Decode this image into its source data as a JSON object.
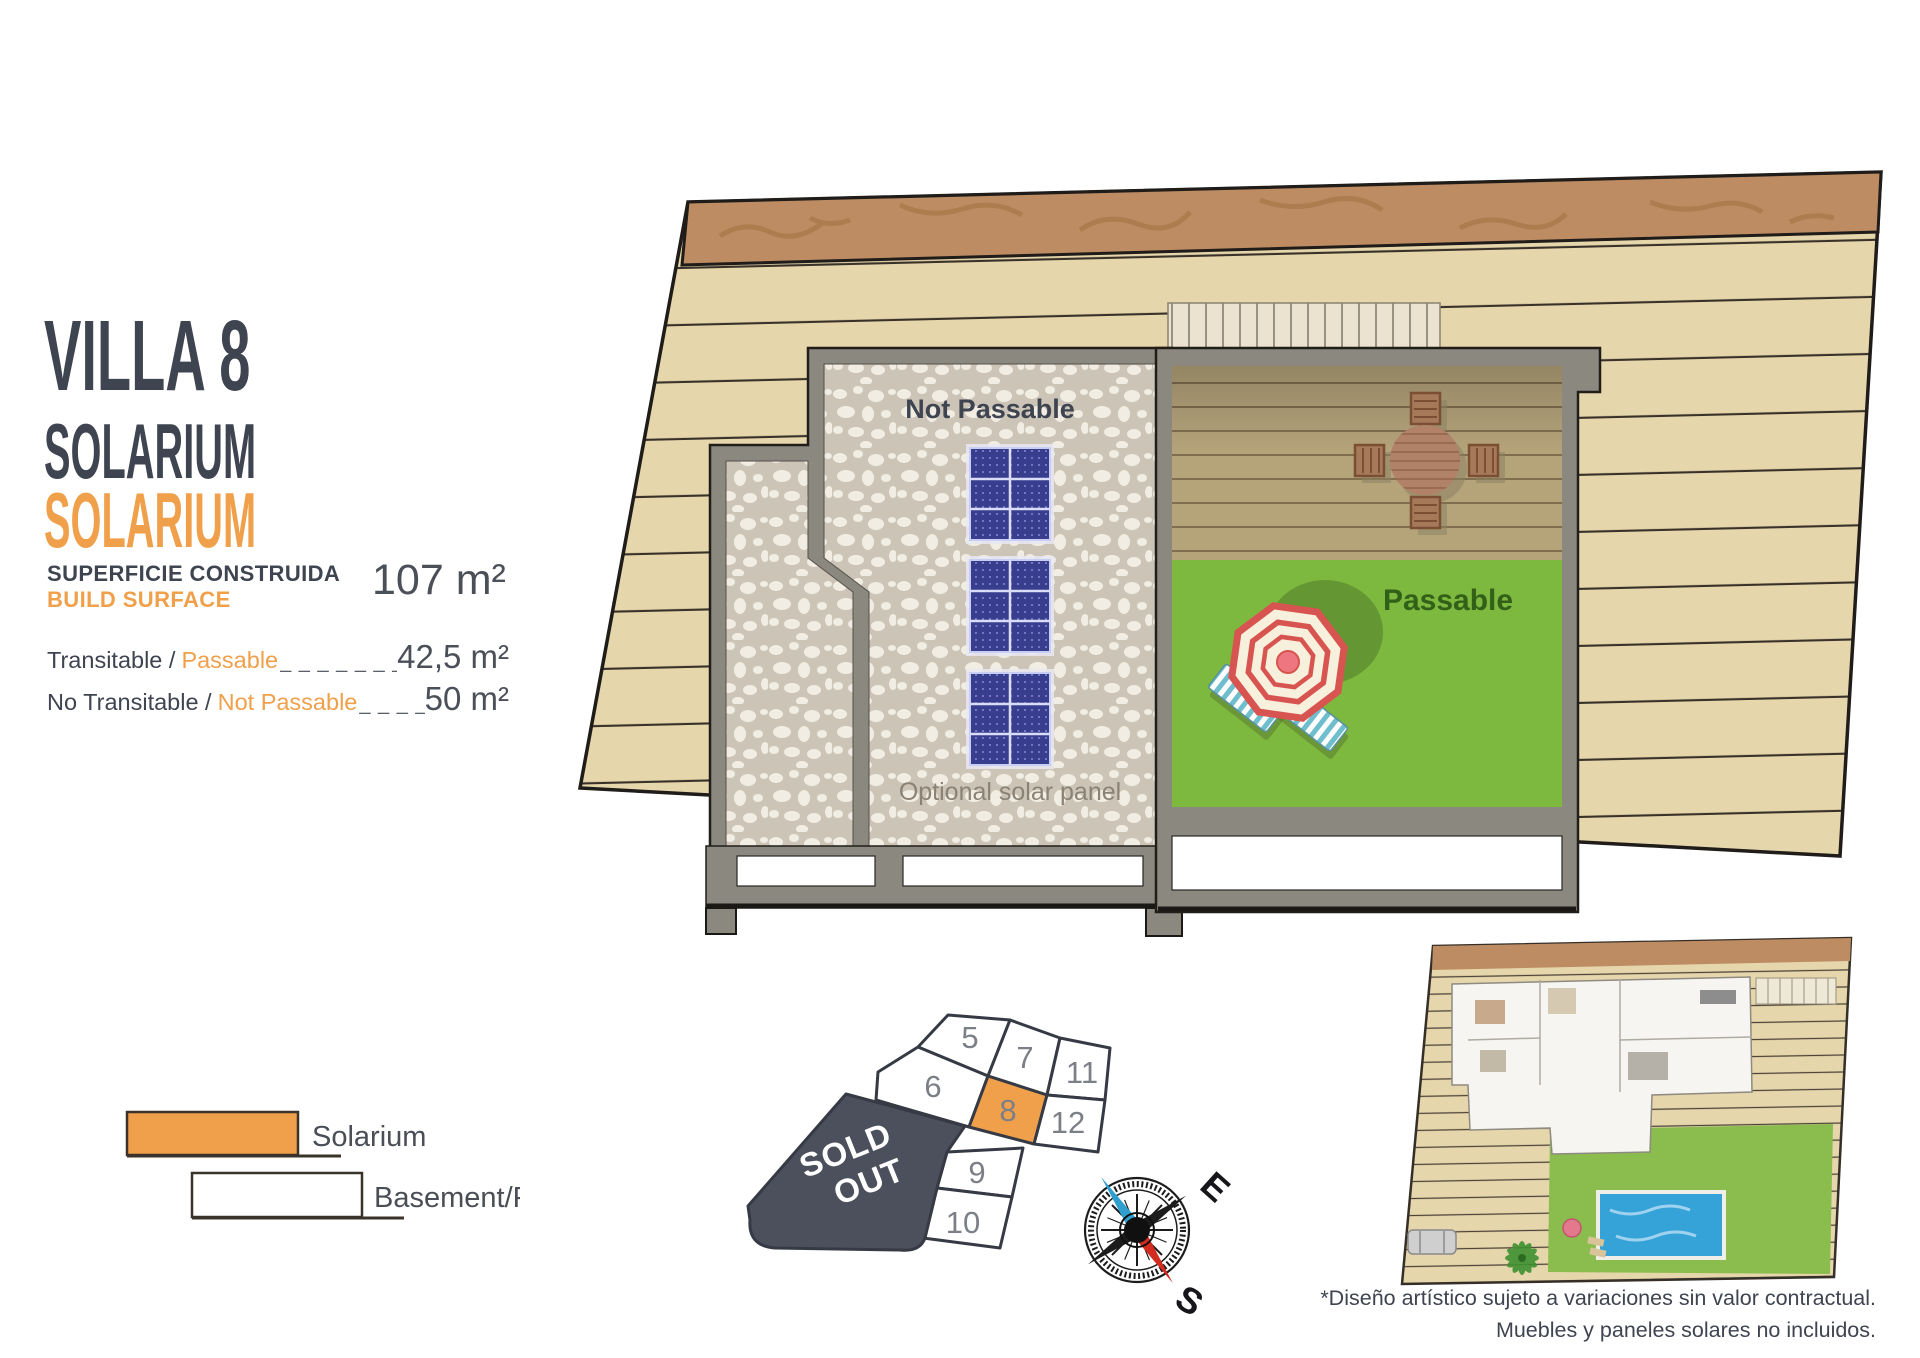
{
  "title_block": {
    "title": "VILLA 8",
    "subtitle": "SOLARIUM",
    "subtitle_accent": "SOLARIUM",
    "surface_label_primary": "SUPERFICIE CONSTRUIDA",
    "surface_label_secondary": "BUILD SURFACE",
    "surface_value": "107 m²"
  },
  "areas": {
    "passable": {
      "label_primary": "Transitable /",
      "label_accent": "Passable",
      "dashes": "_ _ _ _ _ _ _",
      "value": "42,5 m²"
    },
    "not_passable": {
      "label_primary": "No Transitable /",
      "label_accent": "Not Passable",
      "dashes": "_ _ _ _",
      "value": "50 m²"
    }
  },
  "legend": {
    "solarium": {
      "label": "Solarium",
      "swatch_color": "#f0a04a"
    },
    "basement": {
      "label": "Basement/Pool",
      "swatch_color": "#ffffff"
    }
  },
  "floor_plan": {
    "not_passable_label": "Not Passable",
    "passable_label": "Passable",
    "optional_label": "Optional solar panel"
  },
  "site_plan": {
    "numbers": [
      "5",
      "7",
      "11",
      "6",
      "8",
      "12",
      "9",
      "10"
    ],
    "highlighted": "8",
    "sold_out_line1": "SOLD",
    "sold_out_line2": "OUT"
  },
  "compass": {
    "east": "E",
    "south": "S"
  },
  "footnote": {
    "line1": "*Diseño artístico sujeto a variaciones sin valor contractual.",
    "line2": "Muebles y paneles solares no incluidos."
  },
  "colors": {
    "accent": "#f0a04a",
    "dark": "#3e4450",
    "sold_out": "#4b505c",
    "deck_tan": "#e6d6ab",
    "green": "#7db93e",
    "wall_gray": "#8b8880",
    "panel_blue": "#383d8d"
  }
}
